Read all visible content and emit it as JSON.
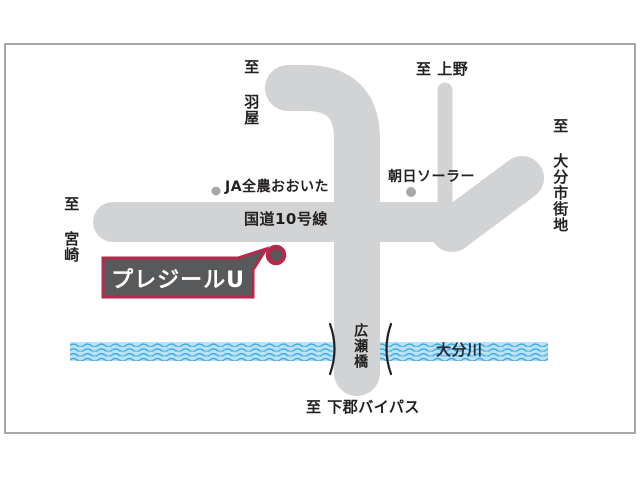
{
  "labels": {
    "to_haneya": "至 羽屋",
    "to_ueno": "至 上野",
    "to_oita_city": "至 大分市街地",
    "to_miyazaki": "至 宮崎",
    "to_shimogori_bypass": "至 下郡バイパス",
    "route10": "国道10号線",
    "ja_zennoh_oita": "JA全農おおいた",
    "asahi_solar": "朝日ソーラー",
    "hirose_bridge": "広瀬橋",
    "oita_river": "大分川",
    "destination": "プレジールU"
  },
  "colors": {
    "road": "#d2d3d5",
    "river_base": "#b7e3f7",
    "river_wave": "#3fa7de",
    "callout_bg": "#58595b",
    "callout_border": "#b5294b",
    "marker_ring": "#b5294b",
    "marker_center": "#58595b",
    "landmark_dot": "#a7a9ac",
    "text": "#231f20",
    "frame_border": "#a6a8ab"
  }
}
